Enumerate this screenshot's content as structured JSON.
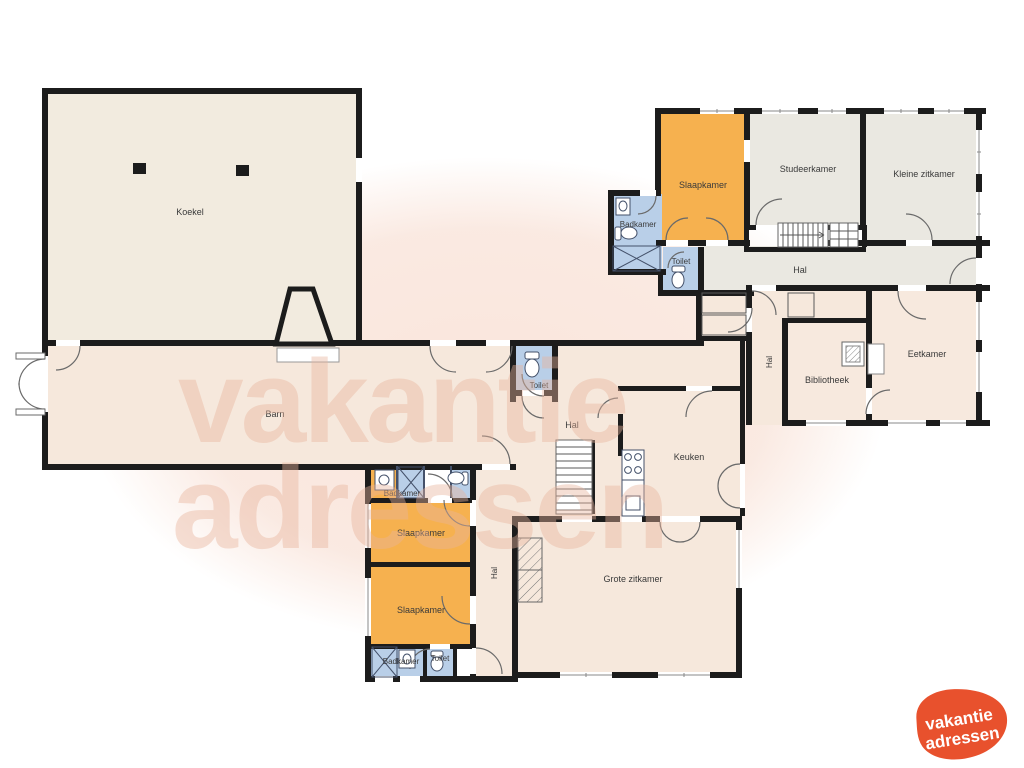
{
  "plan": {
    "rooms": {
      "koekel": "Koekel",
      "barn": "Barn",
      "slaapkamer_tr": "Slaapkamer",
      "studeerkamer": "Studeerkamer",
      "kleine_zitkamer": "Kleine zitkamer",
      "badkamer_tr": "Badkamer",
      "toilet_tr": "Toilet",
      "hal_top": "Hal",
      "eetkamer": "Eetkamer",
      "bibliotheek": "Bibliotheek",
      "hal_mid": "Hal",
      "toilet_mid": "Toilet",
      "hal_center": "Hal",
      "keuken": "Keuken",
      "grote_zitkamer": "Grote zitkamer",
      "badkamer_b1": "Badkamer",
      "slaapkamer_b1": "Slaapkamer",
      "slaapkamer_b2": "Slaapkamer",
      "hal_bottom": "Hal",
      "badkamer_b2": "Badkamer",
      "toilet_b2": "Toilet"
    },
    "colors": {
      "wall": "#1c1c1c",
      "floor_beige": "#f2ebdf",
      "floor_peach": "#f6e8dc",
      "floor_pink": "#f7e9de",
      "floor_gray": "#eae8e1",
      "bedroom_orange": "#f6b14f",
      "bath_blue": "#b9cfe8",
      "blob_pink": "#f9e4da",
      "watermark_pink": "#e9b49c",
      "logo_orange": "#e8512d"
    }
  },
  "watermark": {
    "line1": "vakantie",
    "line2": "adressen"
  },
  "logo": {
    "line1": "vakantie",
    "line2": "adressen"
  }
}
